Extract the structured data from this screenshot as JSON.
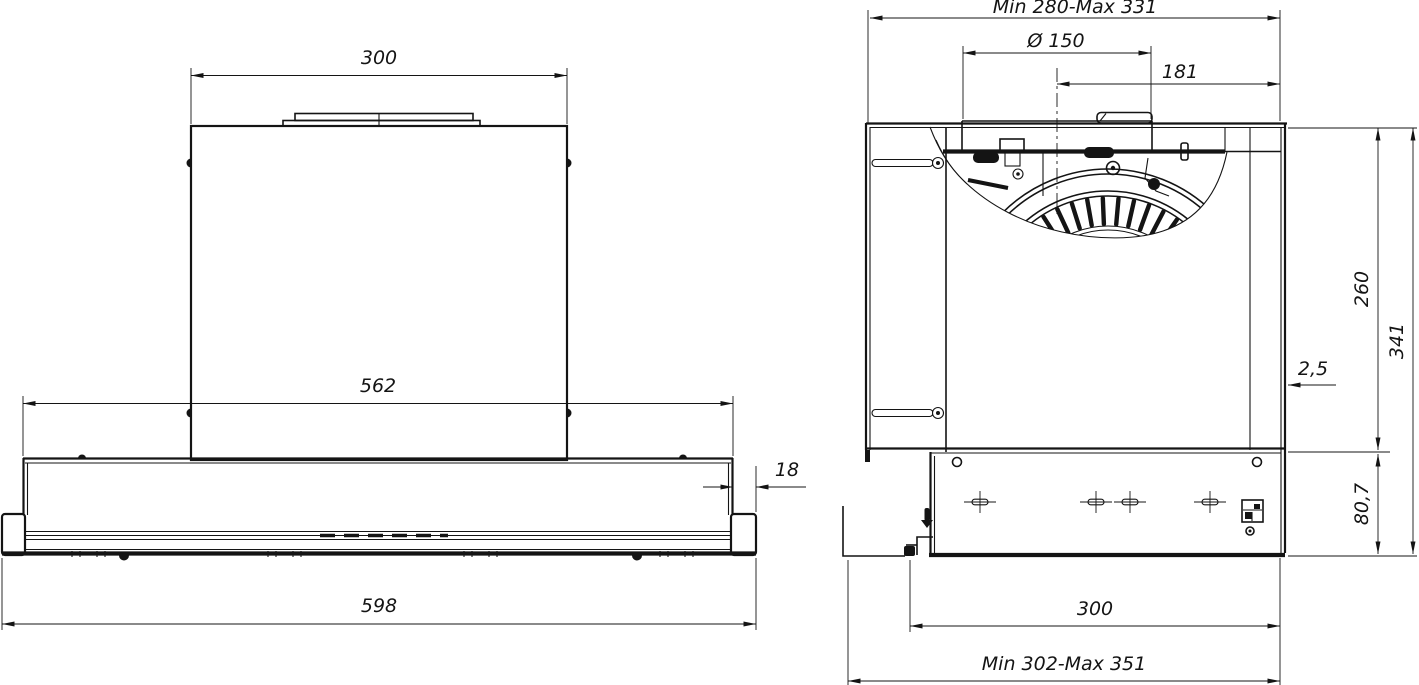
{
  "front_view": {
    "chimney_width": "300",
    "body_width": "562",
    "visor_offset": "18",
    "total_width": "598"
  },
  "side_view": {
    "depth_range": "Min 280-Max 331",
    "duct_diameter": "Ø 150",
    "duct_offset": "181",
    "body_height": "260",
    "overall_height": "341",
    "front_panel_gap": "2,5",
    "lower_section_height": "80,7",
    "mounting_width": "300",
    "overall_depth_range": "Min 302-Max 351"
  },
  "colors": {
    "line": "#141414",
    "background": "#ffffff"
  }
}
